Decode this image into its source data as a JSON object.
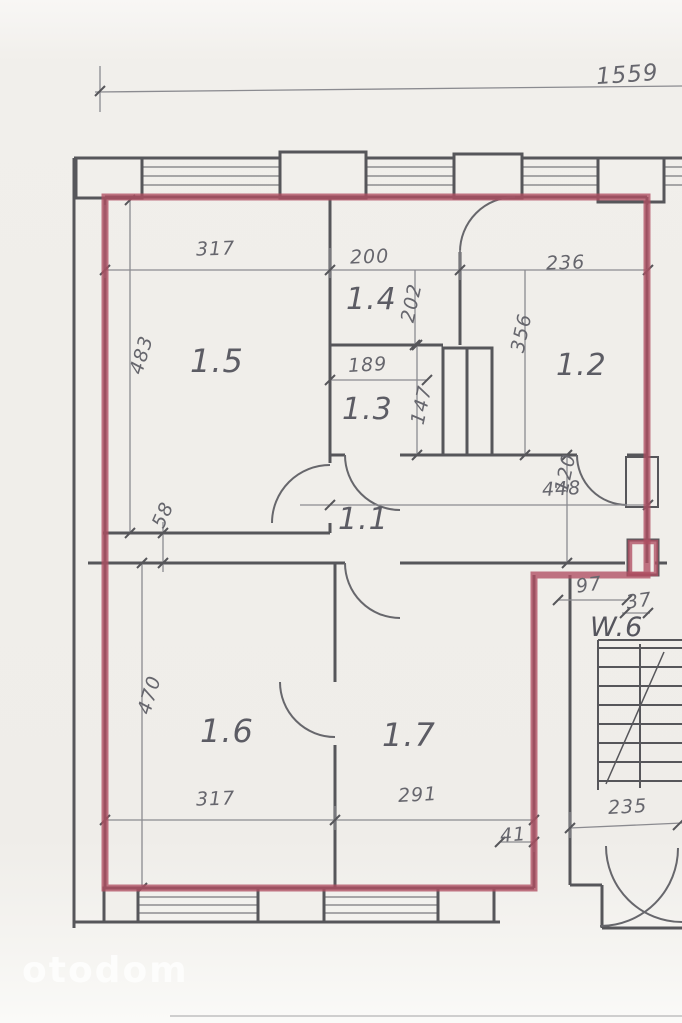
{
  "plan": {
    "type": "apartment-floor-plan",
    "outline_note": "red marker traces apartment boundary",
    "colors": {
      "outline_red": "#b04e62",
      "wall_gray": "#55555a",
      "dim_gray": "#8b8b90",
      "text_gray": "#66666d",
      "paper": "#efede9"
    }
  },
  "watermark": "otodom",
  "rooms": [
    {
      "id": "room-1-5",
      "label": "1.5"
    },
    {
      "id": "room-1-4",
      "label": "1.4"
    },
    {
      "id": "room-1-3",
      "label": "1.3"
    },
    {
      "id": "room-1-2",
      "label": "1.2"
    },
    {
      "id": "room-1-1",
      "label": "1.1"
    },
    {
      "id": "room-1-6",
      "label": "1.6"
    },
    {
      "id": "room-1-7",
      "label": "1.7"
    },
    {
      "id": "stairwell",
      "label": "W.6"
    }
  ],
  "dims": [
    {
      "name": "overall-width",
      "value": "1559"
    },
    {
      "name": "room-1-5-width",
      "value": "317"
    },
    {
      "name": "room-1-4-width",
      "value": "200"
    },
    {
      "name": "room-1-2-width",
      "value": "236"
    },
    {
      "name": "room-1-4-depth",
      "value": "202"
    },
    {
      "name": "room-1-2-depth",
      "value": "356"
    },
    {
      "name": "room-1-3-width",
      "value": "189"
    },
    {
      "name": "room-1-3-depth",
      "value": "147"
    },
    {
      "name": "room-1-5-depth",
      "value": "483"
    },
    {
      "name": "hall-depth",
      "value": "120"
    },
    {
      "name": "hall-width",
      "value": "448"
    },
    {
      "name": "wall-gap",
      "value": "58"
    },
    {
      "name": "entry-width",
      "value": "97"
    },
    {
      "name": "entry-door-width",
      "value": "37"
    },
    {
      "name": "room-1-6-depth",
      "value": "470"
    },
    {
      "name": "room-1-6-width",
      "value": "317"
    },
    {
      "name": "room-1-7-width",
      "value": "291"
    },
    {
      "name": "bottom-offset",
      "value": "41"
    },
    {
      "name": "stair-width",
      "value": "235"
    }
  ]
}
